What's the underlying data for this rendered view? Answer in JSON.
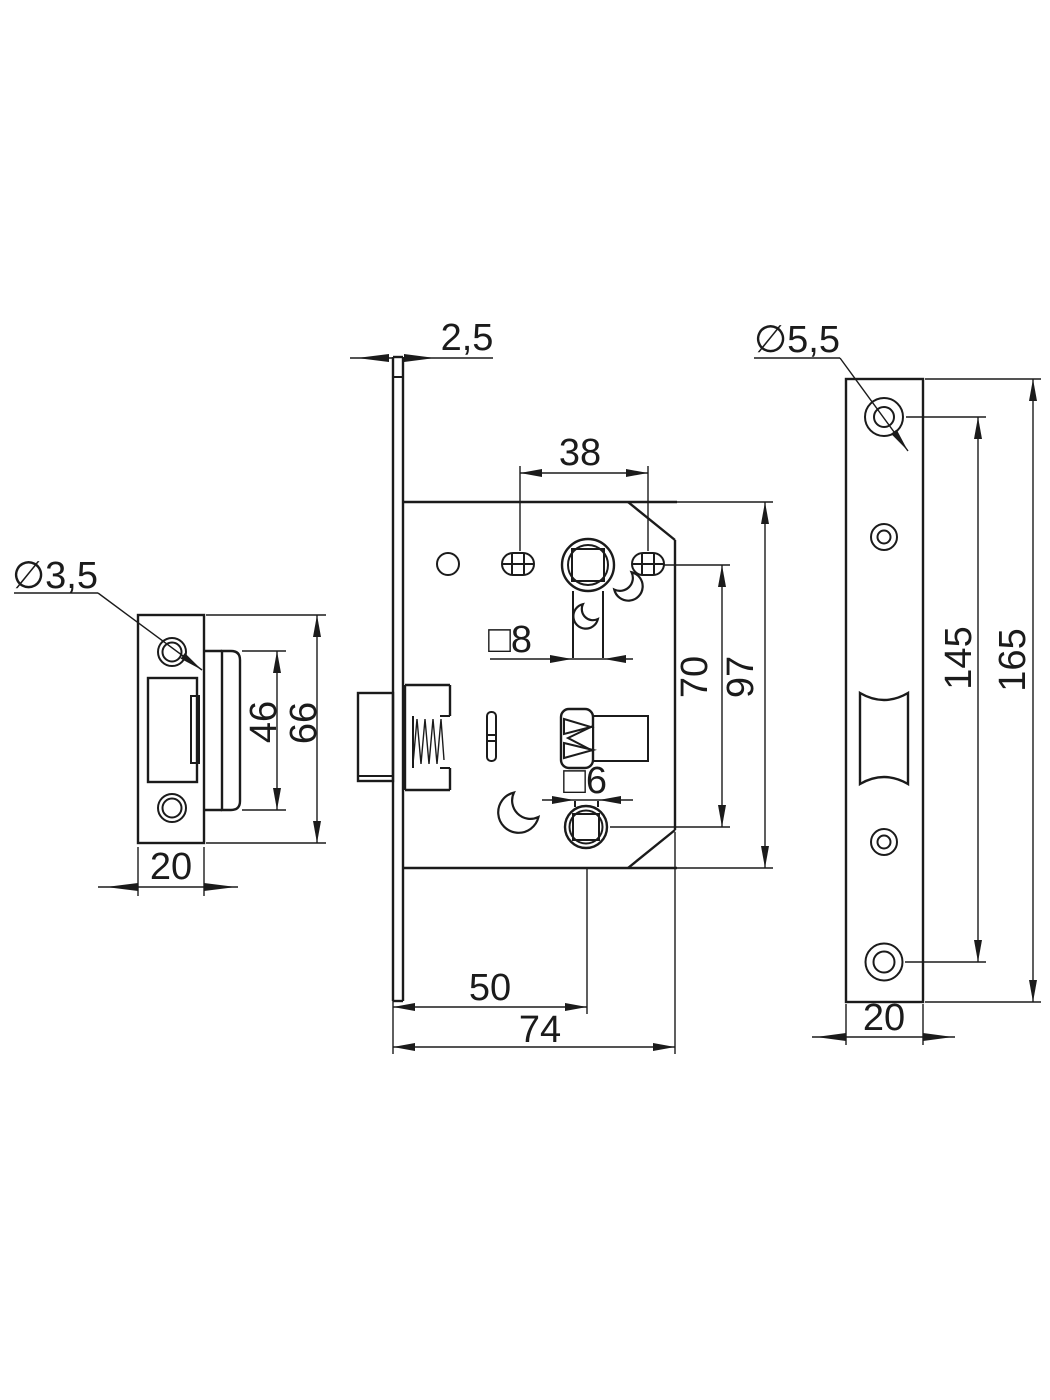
{
  "drawing_title": "mortise latch lock technical drawing, three views",
  "colors": {
    "background": "#ffffff",
    "line": "#1b1b1b"
  },
  "views": {
    "strike_plate": {
      "hole_dia": "∅3,5",
      "cutout_height": "46",
      "plate_height": "66",
      "plate_width": "20"
    },
    "lock_body": {
      "faceplate_thickness": "2,5",
      "hole_spacing": "38",
      "spindle_square": "□8",
      "follower_square": "□6",
      "hub_distance": "70",
      "case_height": "97",
      "backset": "50",
      "case_depth": "74"
    },
    "faceplate": {
      "hole_dia": "∅5,5",
      "screw_spacing": "145",
      "plate_length": "165",
      "plate_width": "20"
    }
  }
}
